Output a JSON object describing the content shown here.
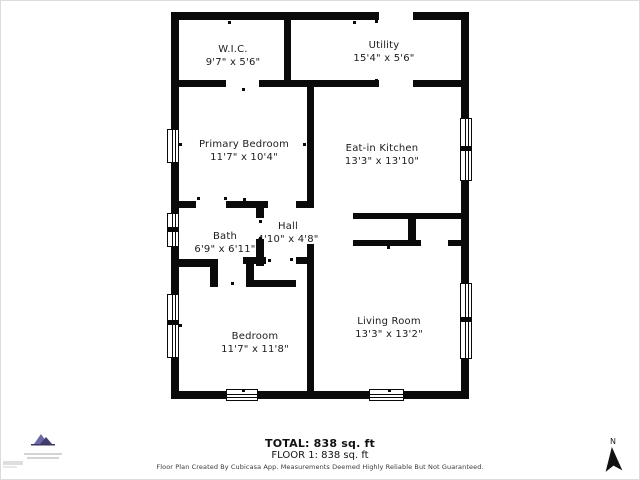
{
  "rooms": [
    {
      "name": "W.I.C.",
      "dims": "9'7\" x 5'6\""
    },
    {
      "name": "Utility",
      "dims": "15'4\" x 5'6\""
    },
    {
      "name": "Primary Bedroom",
      "dims": "11'7\" x 10'4\""
    },
    {
      "name": "Eat-in Kitchen",
      "dims": "13'3\" x 13'10\""
    },
    {
      "name": "Bath",
      "dims": "6'9\" x 6'11\""
    },
    {
      "name": "Hall",
      "dims": "4'10\" x 4'8\""
    },
    {
      "name": "Bedroom",
      "dims": "11'7\" x 11'8\""
    },
    {
      "name": "Living Room",
      "dims": "13'3\" x 13'2\""
    }
  ],
  "summary": {
    "total": "TOTAL: 838 sq. ft",
    "floor": "FLOOR 1: 838 sq. ft"
  },
  "disclaimer": "Floor Plan Created By Cubicasa App. Measurements Deemed Highly Reliable But Not Guaranteed.",
  "compass": {
    "label": "N"
  },
  "colors": {
    "wall": "#0a0a0a",
    "text": "#1c1c1c",
    "logo_purple": "#6c68a8",
    "logo_dark": "#413d6e"
  }
}
